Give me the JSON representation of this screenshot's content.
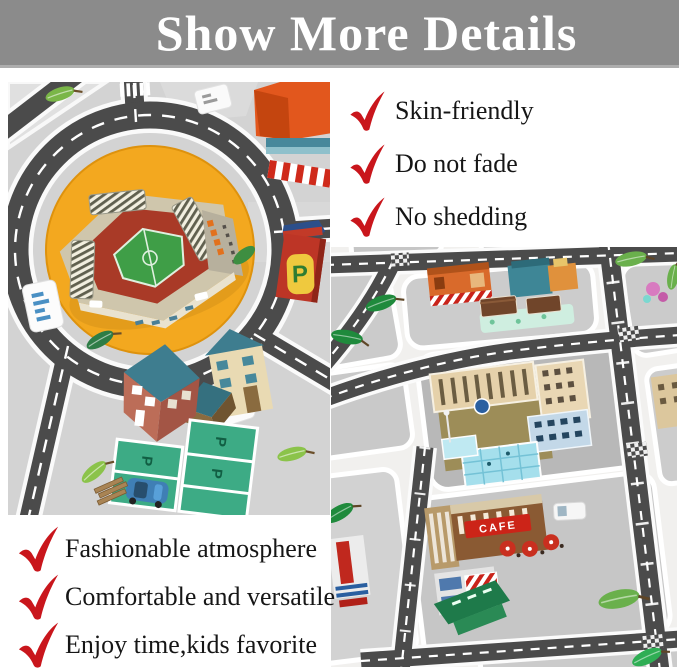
{
  "banner": {
    "title": "Show More Details"
  },
  "features_right": [
    {
      "label": "Skin-friendly"
    },
    {
      "label": "Do not fade"
    },
    {
      "label": "No shedding"
    }
  ],
  "features_bottom": [
    {
      "label": "Fashionable atmosphere"
    },
    {
      "label": "Comfortable and versatile"
    },
    {
      "label": "Enjoy time,kids favorite"
    }
  ],
  "photos": {
    "left": {
      "alt": "City road play mat, overhead view: roundabout with football stadium, houses, green parking lots, trees and road signs",
      "parking_letter": "P"
    },
    "right": {
      "alt": "City road play mat, angled view: street grid with shops, hotel with swimming pool, cafe and market",
      "cafe_sign": "CAFE"
    }
  },
  "theme": {
    "banner_bg": "#8b8b8b",
    "banner_text": "#ffffff",
    "check_red": "#c9161c",
    "feature_text": "#161616",
    "road_dark": "#4b4b4b",
    "mat_gray": "#d3d3d3",
    "roundabout_orange": "#f3a81f",
    "parking_green": "#3dab85"
  }
}
